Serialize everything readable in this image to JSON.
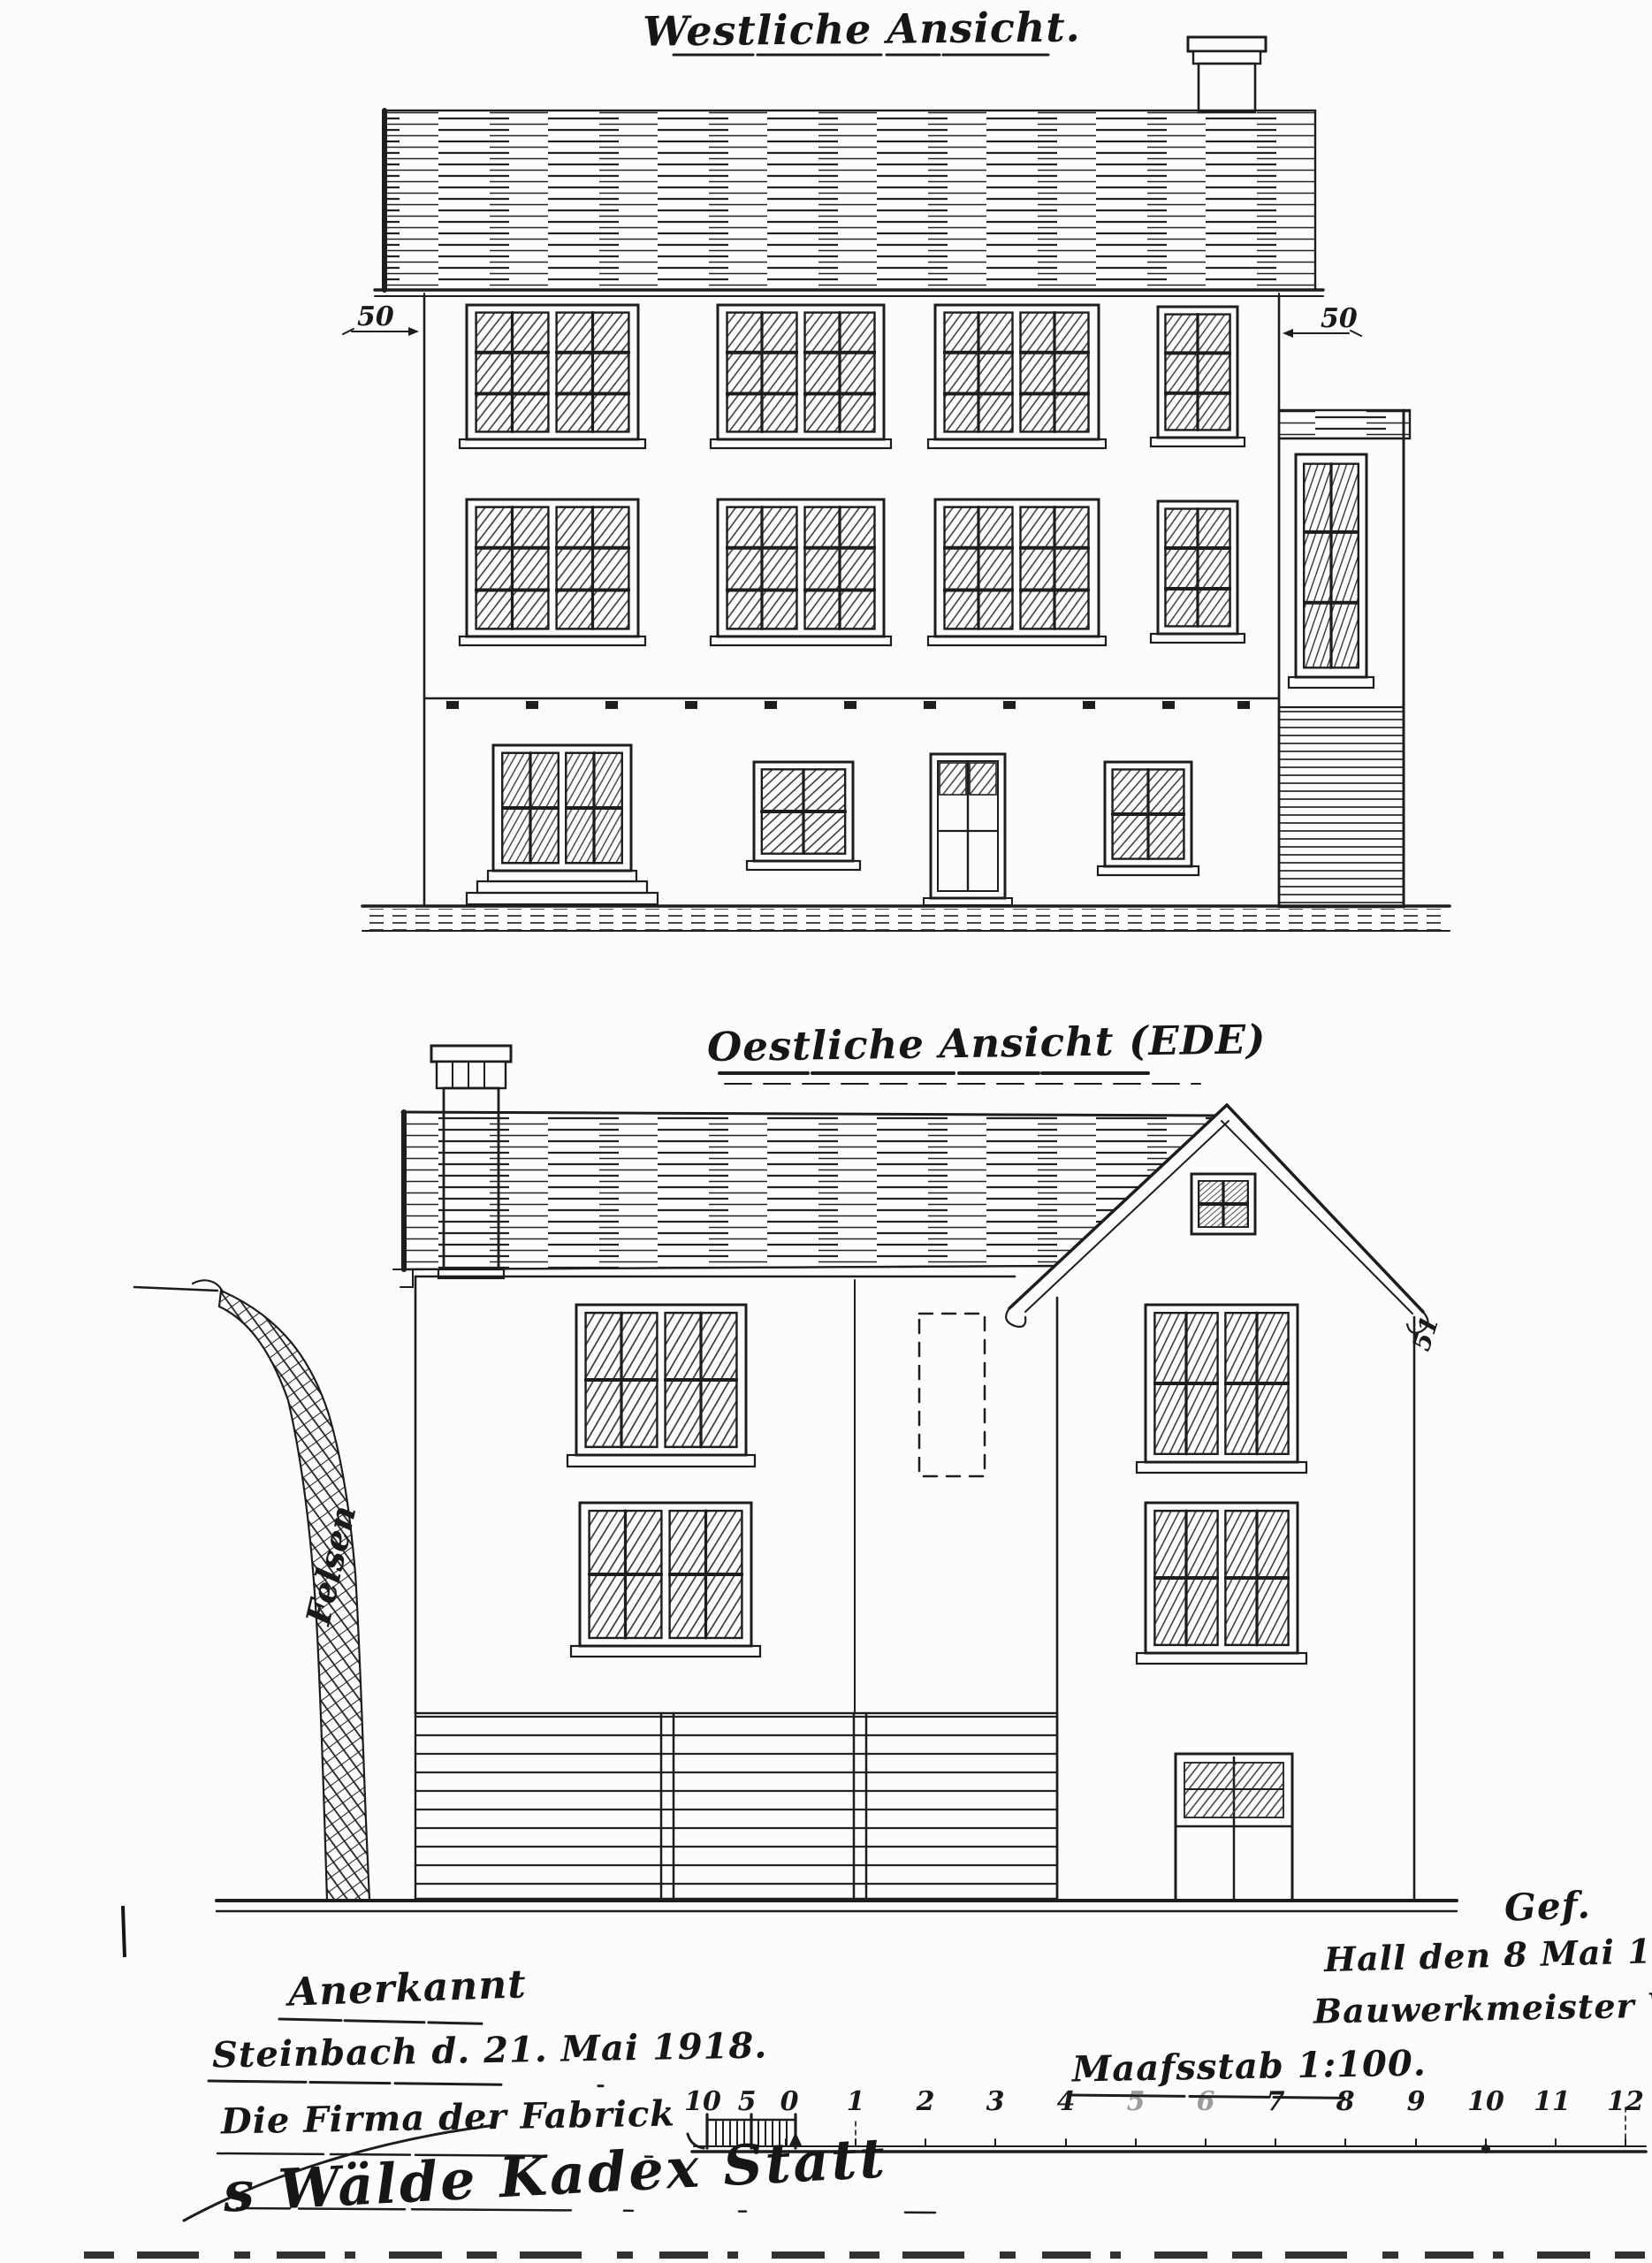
{
  "page": {
    "paper_color": "#fcfcfa",
    "ink_color": "#1a1a1a"
  },
  "west_elevation": {
    "title": "Westliche Ansicht.",
    "dim_left": "50",
    "dim_right": "50"
  },
  "east_elevation": {
    "title": "Oestliche Ansicht (EDE)",
    "rock_label": "Felsen",
    "dim_right": "51"
  },
  "approval_block": {
    "line1": "Anerkannt",
    "line2": "Steinbach d. 21. Mai 1918.",
    "line3": "Die Firma der Fabrick",
    "signature": "s Wälde Kadex Statt"
  },
  "author_block": {
    "line1": "Gef.",
    "line2": "Hall den 8 Mai 1918.",
    "line3": "Bauwerkmeister Weiler."
  },
  "scale_block": {
    "label": "Maafsstab 1:100.",
    "ticks": [
      "10",
      "5",
      "0",
      "1",
      "2",
      "3",
      "4",
      "5",
      "6",
      "7",
      "8",
      "9",
      "10",
      "11",
      "12"
    ]
  }
}
